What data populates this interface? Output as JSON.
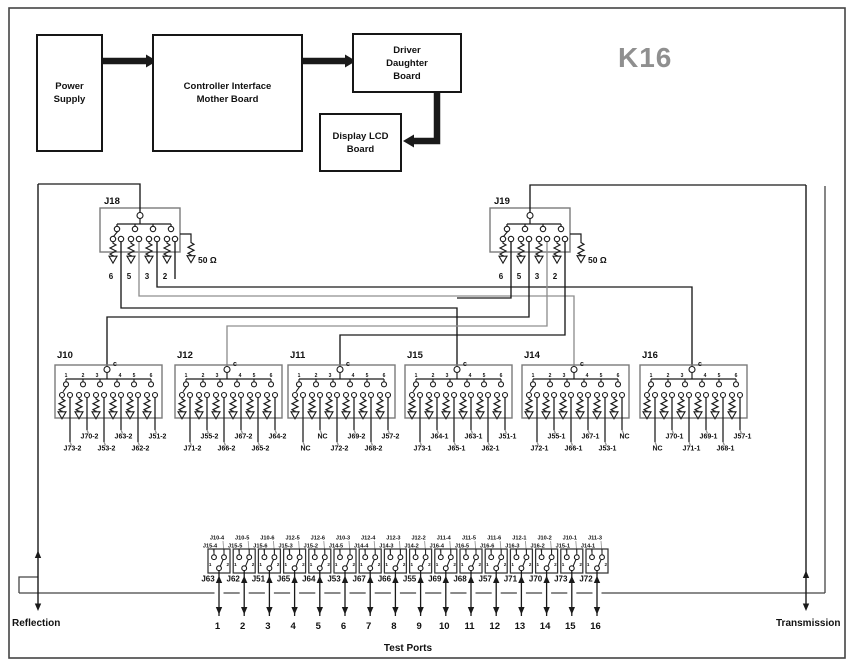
{
  "title": "K16",
  "labels": {
    "reflection": "Reflection",
    "transmission": "Transmission",
    "test_ports": "Test Ports"
  },
  "colors": {
    "line": "#1a1a1a",
    "gray_line": "#8f8f8f",
    "frame": "#444444",
    "box_stroke": "#7a7a7a",
    "title_gray": "#8f8f8f"
  },
  "top_flow": {
    "power_supply": {
      "lines": [
        "Power",
        "Supply"
      ]
    },
    "controller": {
      "lines": [
        "Controller Interface",
        "Mother Board"
      ]
    },
    "driver": {
      "lines": [
        "Driver",
        "Daughter",
        "Board"
      ]
    },
    "display": {
      "lines": [
        "Display LCD",
        "Board"
      ]
    }
  },
  "trees": [
    {
      "name": "J18",
      "outputs": [
        "6",
        "5",
        "3",
        "2"
      ],
      "load_label": "50 Ω"
    },
    {
      "name": "J19",
      "outputs": [
        "6",
        "5",
        "3",
        "2"
      ],
      "load_label": "50 Ω"
    }
  ],
  "blocks": [
    {
      "name": "J10",
      "common_label": "c",
      "pin_labels": [
        "1",
        "2",
        "3",
        "4",
        "5",
        "6"
      ],
      "outputs": [
        "J73-2",
        "J70-2",
        "J53-2",
        "J63-2",
        "J62-2",
        "J51-2"
      ]
    },
    {
      "name": "J12",
      "common_label": "c",
      "pin_labels": [
        "1",
        "2",
        "3",
        "4",
        "5",
        "6"
      ],
      "outputs": [
        "J71-2",
        "J55-2",
        "J66-2",
        "J67-2",
        "J65-2",
        "J64-2"
      ]
    },
    {
      "name": "J11",
      "common_label": "c",
      "pin_labels": [
        "1",
        "2",
        "3",
        "4",
        "5",
        "6"
      ],
      "outputs": [
        "NC",
        "NC",
        "J72-2",
        "J69-2",
        "J68-2",
        "J57-2"
      ]
    },
    {
      "name": "J15",
      "common_label": "c",
      "pin_labels": [
        "1",
        "2",
        "3",
        "4",
        "5",
        "6"
      ],
      "outputs": [
        "J73-1",
        "J64-1",
        "J65-1",
        "J63-1",
        "J62-1",
        "J51-1"
      ]
    },
    {
      "name": "J14",
      "common_label": "c",
      "pin_labels": [
        "1",
        "2",
        "3",
        "4",
        "5",
        "6"
      ],
      "outputs": [
        "J72-1",
        "J55-1",
        "J66-1",
        "J67-1",
        "J53-1",
        "NC"
      ]
    },
    {
      "name": "J16",
      "common_label": "c",
      "pin_labels": [
        "1",
        "2",
        "3",
        "4",
        "5",
        "6"
      ],
      "outputs": [
        "NC",
        "J70-1",
        "J71-1",
        "J69-1",
        "J68-1",
        "J57-1"
      ]
    }
  ],
  "connectors": [
    {
      "name": "J63",
      "contact_labels": [
        "1",
        "2"
      ],
      "cables": [
        "J10-4",
        "J15-4"
      ],
      "port": "1"
    },
    {
      "name": "J62",
      "contact_labels": [
        "1",
        "2"
      ],
      "cables": [
        "J10-5",
        "J15-5"
      ],
      "port": "2"
    },
    {
      "name": "J51",
      "contact_labels": [
        "1",
        "2"
      ],
      "cables": [
        "J10-6",
        "J15-6"
      ],
      "port": "3"
    },
    {
      "name": "J65",
      "contact_labels": [
        "1",
        "2"
      ],
      "cables": [
        "J12-5",
        "J15-3"
      ],
      "port": "4"
    },
    {
      "name": "J64",
      "contact_labels": [
        "1",
        "2"
      ],
      "cables": [
        "J12-6",
        "J15-2"
      ],
      "port": "5"
    },
    {
      "name": "J53",
      "contact_labels": [
        "1",
        "2"
      ],
      "cables": [
        "J10-3",
        "J14-5"
      ],
      "port": "6"
    },
    {
      "name": "J67",
      "contact_labels": [
        "1",
        "2"
      ],
      "cables": [
        "J12-4",
        "J14-4"
      ],
      "port": "7"
    },
    {
      "name": "J66",
      "contact_labels": [
        "1",
        "2"
      ],
      "cables": [
        "J12-3",
        "J14-3"
      ],
      "port": "8"
    },
    {
      "name": "J55",
      "contact_labels": [
        "1",
        "2"
      ],
      "cables": [
        "J12-2",
        "J14-2"
      ],
      "port": "9"
    },
    {
      "name": "J69",
      "contact_labels": [
        "1",
        "2"
      ],
      "cables": [
        "J11-4",
        "J16-4"
      ],
      "port": "10"
    },
    {
      "name": "J68",
      "contact_labels": [
        "1",
        "2"
      ],
      "cables": [
        "J11-5",
        "J16-5"
      ],
      "port": "11"
    },
    {
      "name": "J57",
      "contact_labels": [
        "1",
        "2"
      ],
      "cables": [
        "J11-6",
        "J16-6"
      ],
      "port": "12"
    },
    {
      "name": "J71",
      "contact_labels": [
        "1",
        "2"
      ],
      "cables": [
        "J12-1",
        "J16-3"
      ],
      "port": "13"
    },
    {
      "name": "J70",
      "contact_labels": [
        "1",
        "2"
      ],
      "cables": [
        "J10-2",
        "J16-2"
      ],
      "port": "14"
    },
    {
      "name": "J73",
      "contact_labels": [
        "1",
        "2"
      ],
      "cables": [
        "J10-1",
        "J15-1"
      ],
      "port": "15"
    },
    {
      "name": "J72",
      "contact_labels": [
        "1",
        "2"
      ],
      "cables": [
        "J11-3",
        "J14-1"
      ],
      "port": "16"
    }
  ]
}
